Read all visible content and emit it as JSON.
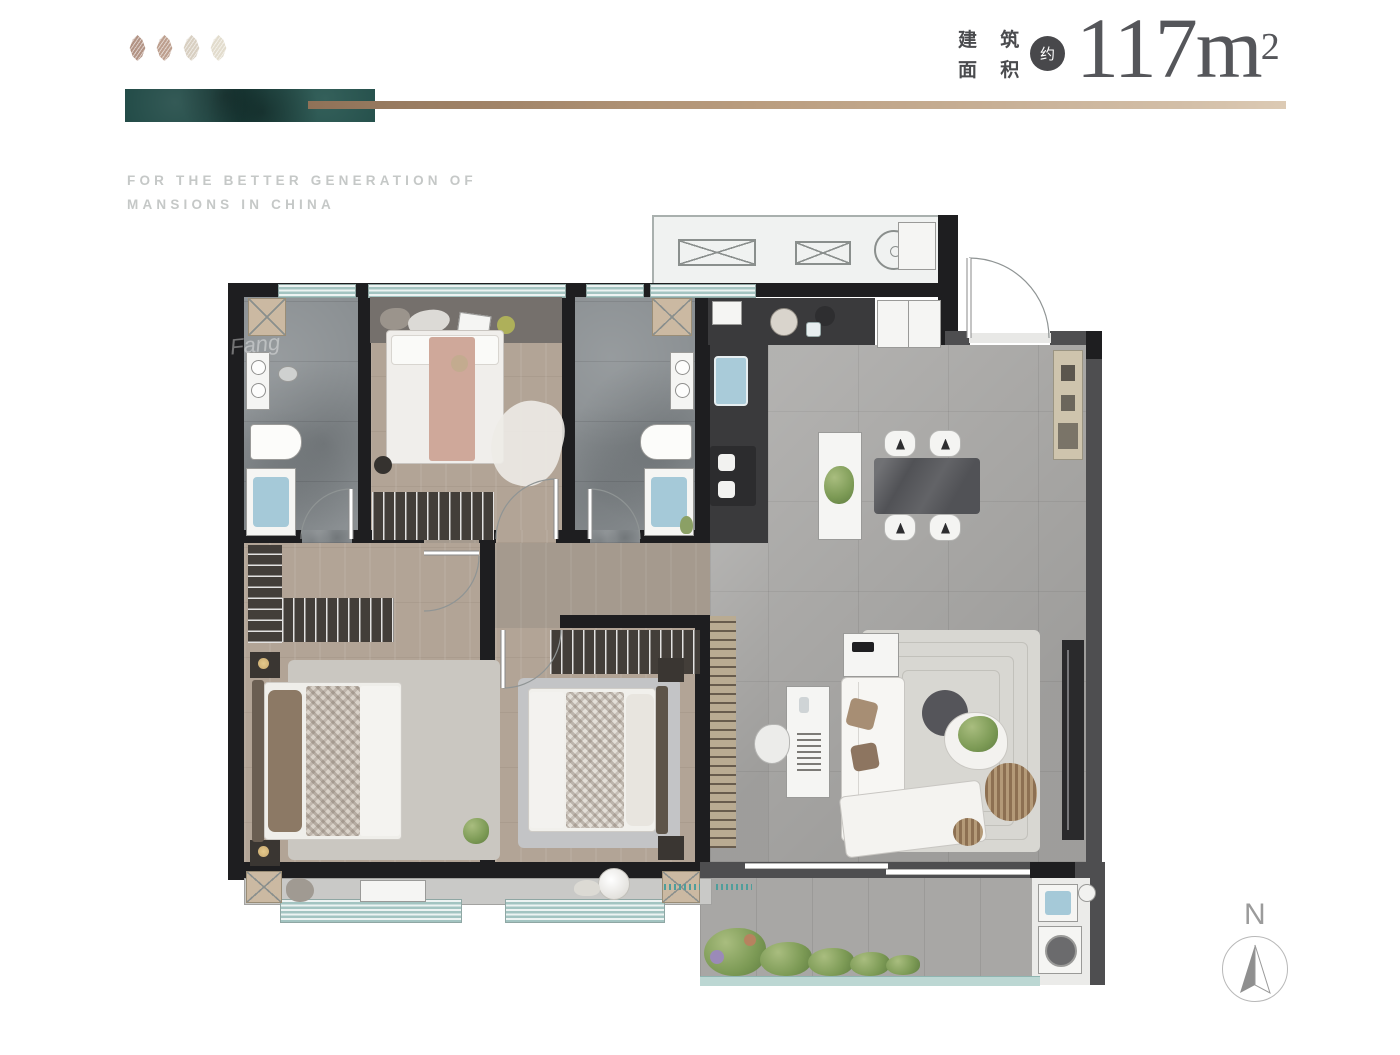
{
  "header": {
    "tagline_line1": "FOR THE BETTER GENERATION OF",
    "tagline_line2": "MANSIONS IN CHINA",
    "area_label_row1": "建 筑",
    "area_label_row2": "面 积",
    "approx_badge": "约",
    "area_value": "117m",
    "area_superscript": "2"
  },
  "compass": {
    "label": "N"
  },
  "watermark": {
    "text": "Fang"
  },
  "palette": {
    "brand_teal": "#1d4743",
    "brand_gold": "#b99c7e",
    "heading_text": "#55565a",
    "tagline_text": "#c5c8c7",
    "wall_black": "#1e1e20",
    "wall_gray": "#4e4e50",
    "window_teal": "#a3c4c1",
    "wood_floor": "#b2a496",
    "marble_floor": "#a8a7a5",
    "balcony_rail": "#bcd7d3",
    "leaf_colors": [
      "#b29384",
      "#bd9f8e",
      "#d8cfc1",
      "#e2dccd"
    ]
  }
}
